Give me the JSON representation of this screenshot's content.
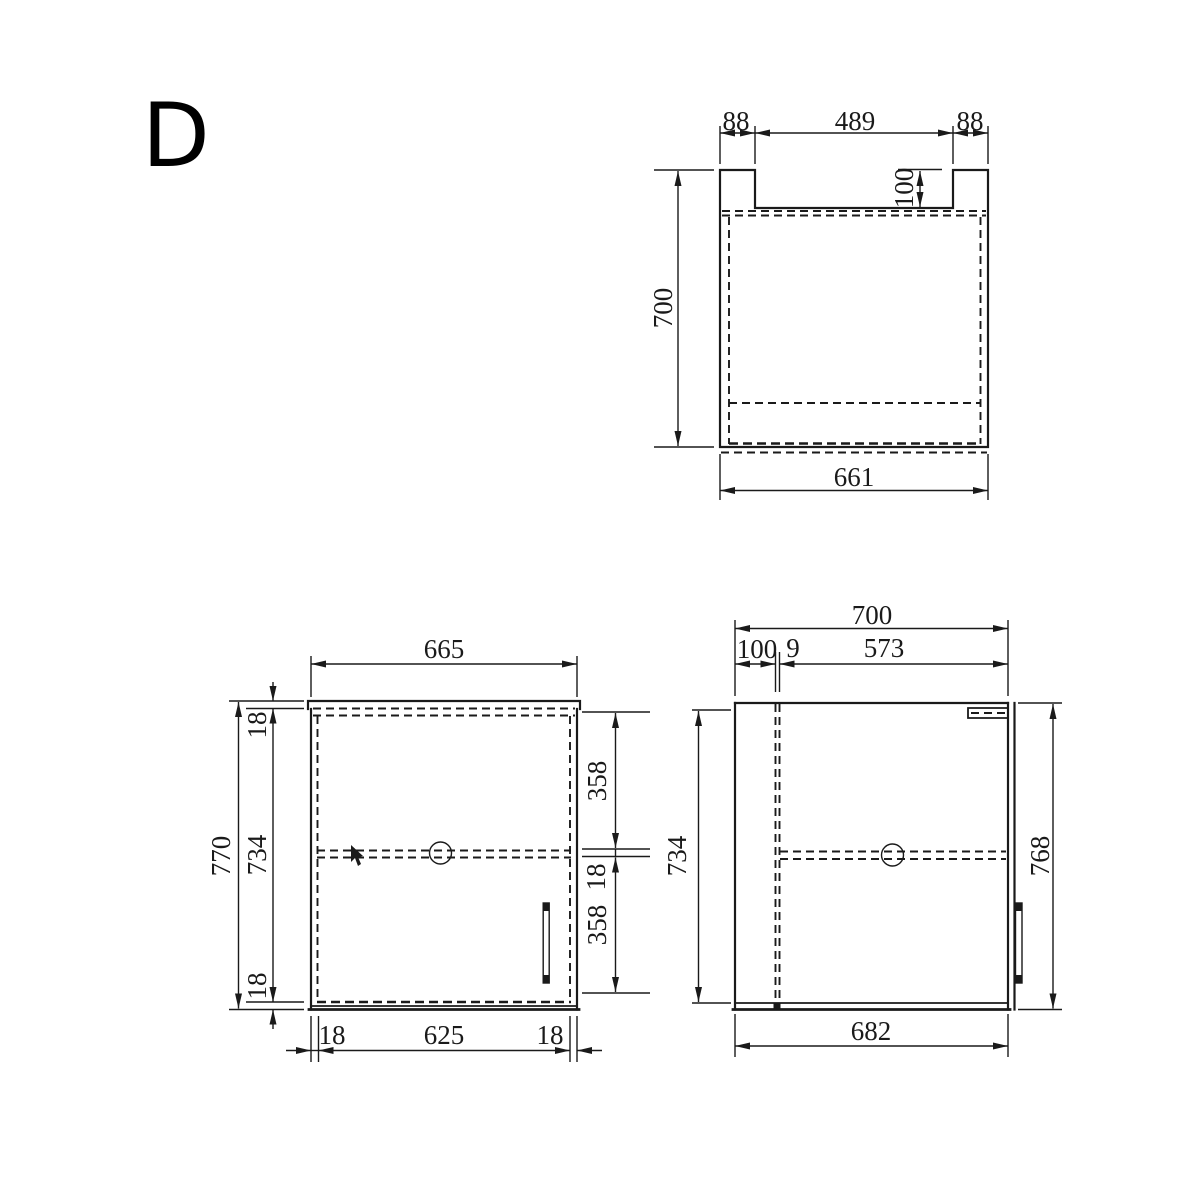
{
  "page": {
    "title_letter": "D"
  },
  "colors": {
    "background": "#ffffff",
    "line": "#1a1a1a"
  },
  "views": {
    "top_view": {
      "label": "top view",
      "dims": {
        "side_panel_left": "88",
        "back_opening": "489",
        "side_panel_right": "88",
        "back_rail_depth": "100",
        "overall_depth": "700",
        "front_width": "661"
      }
    },
    "front_view": {
      "label": "front view",
      "dims": {
        "overall_width": "665",
        "overall_height": "770",
        "top_panel": "18",
        "inner_height": "734",
        "bottom_panel": "18",
        "upper_section": "358",
        "shelf_thickness": "18",
        "lower_section": "358",
        "left_panel": "18",
        "inner_width": "625",
        "right_panel": "18"
      }
    },
    "side_view": {
      "label": "side view",
      "dims": {
        "overall_depth": "700",
        "back_clearance": "100",
        "back_panel": "9",
        "inner_depth": "573",
        "inner_height": "734",
        "overall_height": "768",
        "bottom_depth": "682"
      }
    }
  }
}
